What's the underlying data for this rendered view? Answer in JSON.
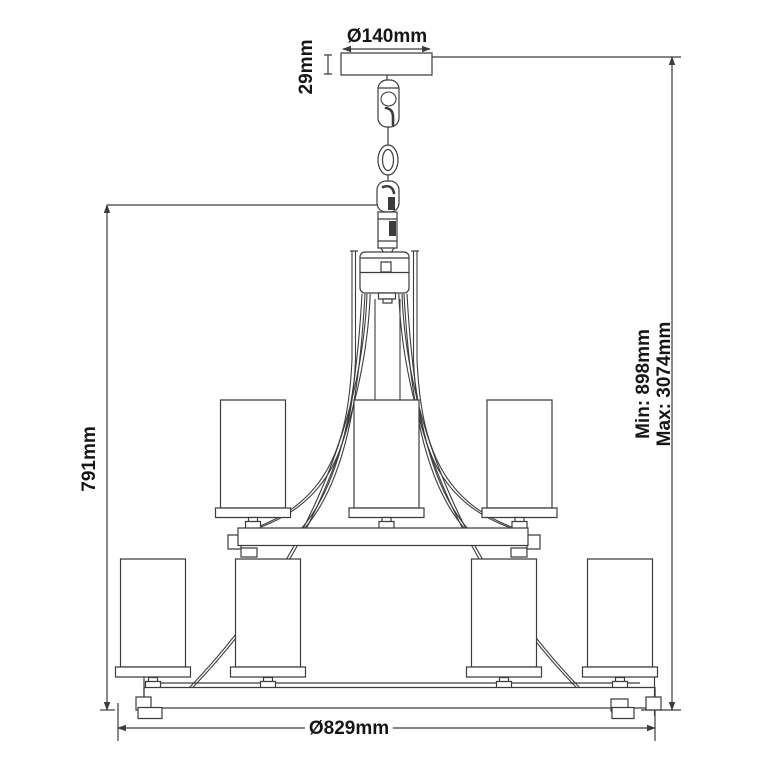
{
  "drawing": {
    "type": "chandelier-technical-dimension-diagram",
    "background": "#ffffff",
    "line_color": "#3c3c3c",
    "text_color": "#161616",
    "dimensions": {
      "canopy_diameter": "Ø140mm",
      "canopy_height": "29mm",
      "fixture_height": "791mm",
      "min_drop": "Min: 898mm",
      "max_drop": "Max: 3074mm",
      "fixture_diameter": "Ø829mm"
    }
  }
}
